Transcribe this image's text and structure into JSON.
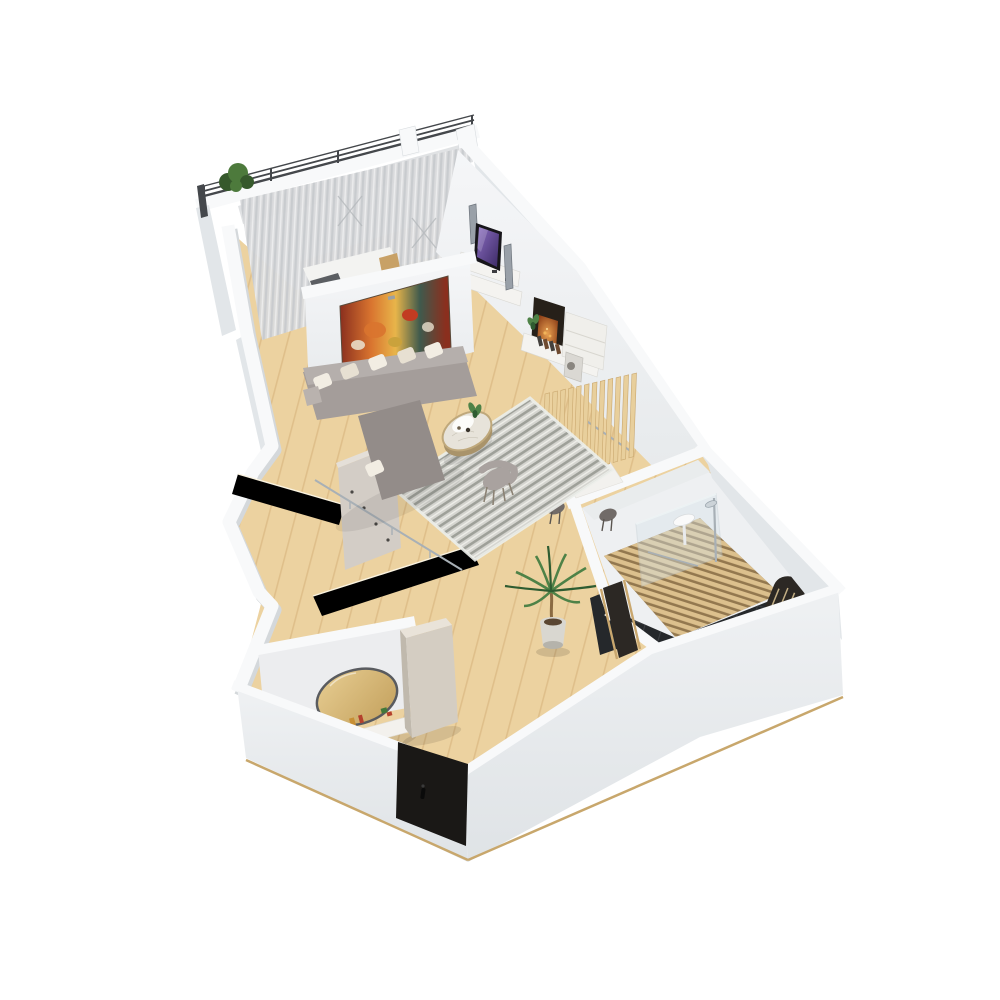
{
  "scene": {
    "title": "3D isometric apartment floor plan render",
    "style": "photoreal cutaway model, white walls, oak parquet floor, transparent background",
    "areas": [
      {
        "name": "balcony",
        "items": [
          "metal-railing",
          "white-parapet",
          "green-shrub"
        ]
      },
      {
        "name": "bedroom",
        "items": [
          "sheer-curtains",
          "window-mullions",
          "white-bed",
          "dark-cushion",
          "wood-headboard"
        ]
      },
      {
        "name": "living-room",
        "items": [
          "wall-art-floral-painting",
          "gray-sectional-sofa",
          "white-throw-pillows",
          "striped-gray-rug",
          "round-marble-coffee-table",
          "serving-tray",
          "accent-chair",
          "small-plant",
          "tv-media-wall",
          "tower-speakers",
          "fireplace-media-console",
          "books",
          "leaning-frame",
          "white-shelf-unit"
        ]
      },
      {
        "name": "dining-nook",
        "items": [
          "wood-slat-partition",
          "small-white-table",
          "two-dark-stools",
          "clothes-rail",
          "floor-lamp"
        ]
      },
      {
        "name": "bathroom",
        "items": [
          "glass-shower-screen",
          "chrome-shower-set",
          "wall-basin",
          "teak-duckboard-floor",
          "black-marble-tiles",
          "arched-slat-niche",
          "wood-door-frame"
        ]
      },
      {
        "name": "hallway",
        "items": [
          "potted-palm",
          "bathroom-door"
        ]
      },
      {
        "name": "entry",
        "items": [
          "oval-gold-mirror",
          "white-vanity-console",
          "cosmetics-set",
          "teal-jar",
          "tall-wardrobe",
          "white-radiator",
          "black-entrance-door",
          "door-handle"
        ]
      },
      {
        "name": "kitchenette",
        "items": [
          "cream-counter",
          "coat-panel-with-hooks",
          "wall-rail"
        ]
      }
    ]
  },
  "palette": {
    "page_bg": "#ffffff",
    "wall_top": "#f8f9fa",
    "wall_face": "#e2e6e9",
    "wall_face2": "#eef0f2",
    "wall_face3": "#e9eced",
    "wall_shadow": "#d4d8db",
    "inner_hi": "#f5f6f8",
    "inner_lo": "#e7eaec",
    "front_hi": "#eff1f3",
    "front_lo": "#dfe3e6",
    "floor": "#ecd2a0",
    "floor_dark": "#e0c184",
    "parquet_line": "#caa368",
    "base_line": "#c8a76c",
    "curtain": "#d8dadc",
    "curtain_streak": "#c2c6c9",
    "railing": "#44474b",
    "bush1": "#4d7a3c",
    "bush2": "#36592c",
    "bed": "#f3f3f1",
    "bed_cushion": "#5b5e62",
    "bed_wood": "#c8a166",
    "paint1": "#8a2f1e",
    "paint2": "#d9742f",
    "paint3": "#e8b54a",
    "paint4": "#3f5a4d",
    "paint_cream": "#e9ddc8",
    "label_gray": "#9aa0a4",
    "sofa": "#a49d9a",
    "sofa_dark": "#938c89",
    "pillow": "#f2ede3",
    "pillow2": "#e7e0d2",
    "rug": "#d5d5d0",
    "rug_stripe": "#94968f",
    "rug_white": "#f4f4f0",
    "table_top": "#e7e3da",
    "table_rim": "#bfa87b",
    "table_side": "#a9936a",
    "tray": "#fcfcfa",
    "chair": "#a9a29f",
    "chair_leg": "#8b8274",
    "tv_frame": "#17151a",
    "scr1": "#8a6cc0",
    "scr2": "#3c2a66",
    "speaker": "#99a0a8",
    "speaker_dark": "#6e757d",
    "unit": "#f4f3f0",
    "unit_shadow": "#d9d8d3",
    "fire_panel": "#262019",
    "glow1": "#e8a050",
    "glow2": "#8a3c16",
    "book1": "#44403c",
    "book2": "#6e4a30",
    "slat": "#e8cf9c",
    "slat_edge": "#c9a76e",
    "dtable": "#f2f1ee",
    "stool": "#716b68",
    "chrome": "#a8b0b6",
    "glass": "#d7e4e9",
    "duck": "#dcc08d",
    "duck_gap": "#93784f",
    "tile": "#25282b",
    "tile_line": "#3d4145",
    "arch_dark": "#2c2824",
    "palm1": "#4e8247",
    "palm2": "#2e5c31",
    "trunk": "#8a6a42",
    "pot": "#d9d7d0",
    "pot_shade": "#b5b3ab",
    "soil": "#5a4632",
    "mirror1": "#e7cd92",
    "mirror2": "#c3a05c",
    "mirror_rim": "#595b5f",
    "console": "#f3f1ed",
    "ward_top": "#e9e3d9",
    "ward_front": "#d4cdc2",
    "ward_side": "#c0b9ad",
    "door": "#1a1816",
    "handle": "#0a0a0a",
    "cos_gold": "#c78f35",
    "cos_red": "#b4412d",
    "cos_teal": "#38b2ab",
    "cos_green": "#41783a",
    "cos_white": "#f6f5f2",
    "radiator": "#f4f4f2"
  }
}
